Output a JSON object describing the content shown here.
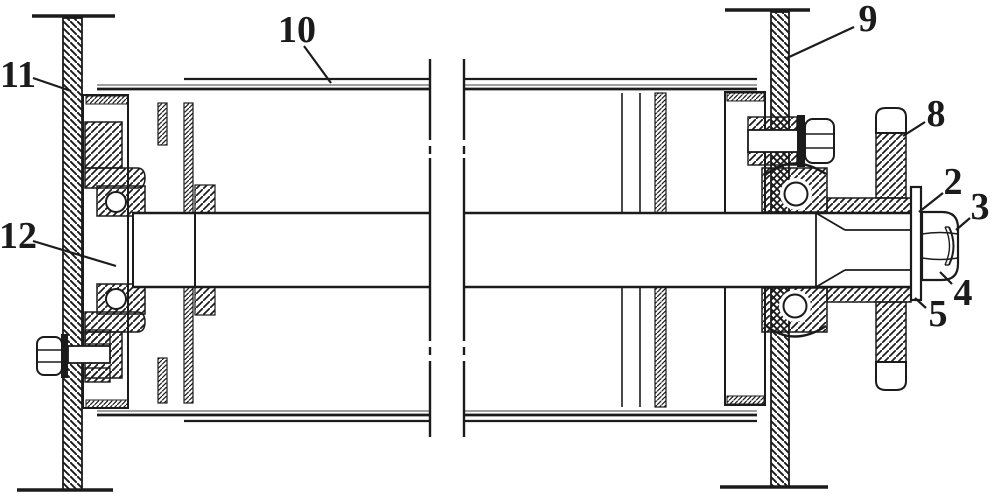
{
  "figure": {
    "type": "patent-cross-section-drawing",
    "background": "#ffffff",
    "ink": "#1b1b1b",
    "lagging_line_color": "#666666",
    "callouts": [
      {
        "label": "10",
        "target": "drum-lagging",
        "tx": 297,
        "ty": 30,
        "x1": 304,
        "y1": 46,
        "x2": 331,
        "y2": 83
      },
      {
        "label": "9",
        "target": "right-wall",
        "tx": 868,
        "ty": 19,
        "x1": 854,
        "y1": 27,
        "x2": 787,
        "y2": 58
      },
      {
        "label": "11",
        "target": "left-wall",
        "tx": 18,
        "ty": 75,
        "x1": 33,
        "y1": 78,
        "x2": 71,
        "y2": 91
      },
      {
        "label": "12",
        "target": "left-bearing-hub",
        "tx": 18,
        "ty": 236,
        "x1": 33,
        "y1": 241,
        "x2": 116,
        "y2": 266
      },
      {
        "label": "8",
        "target": "sprocket-wheel",
        "tx": 936,
        "ty": 114,
        "x1": 925,
        "y1": 122,
        "x2": 903,
        "y2": 136
      },
      {
        "label": "2",
        "target": "shaft-washer",
        "tx": 953,
        "ty": 182,
        "x1": 943,
        "y1": 193,
        "x2": 919,
        "y2": 212
      },
      {
        "label": "3",
        "target": "shaft-end",
        "tx": 980,
        "ty": 207,
        "x1": 970,
        "y1": 218,
        "x2": 956,
        "y2": 230
      },
      {
        "label": "4",
        "target": "shaft-nut",
        "tx": 963,
        "ty": 293,
        "x1": 952,
        "y1": 284,
        "x2": 940,
        "y2": 272
      },
      {
        "label": "5",
        "target": "washer-lower-edge",
        "tx": 938,
        "ty": 314,
        "x1": 926,
        "y1": 308,
        "x2": 915,
        "y2": 298
      }
    ]
  }
}
